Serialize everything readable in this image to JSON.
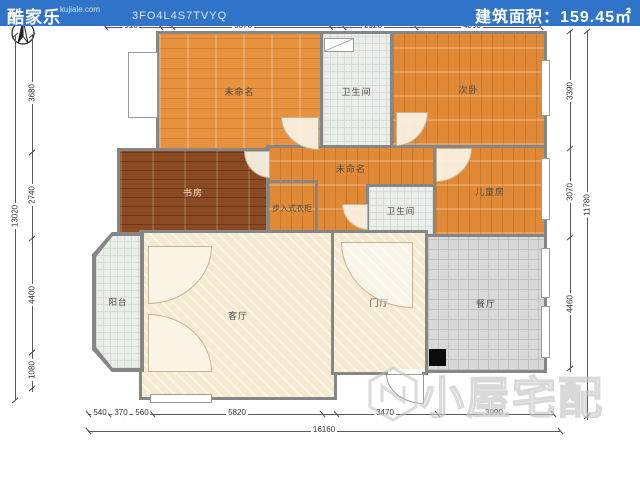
{
  "north": "北",
  "rooms": {
    "unnamed_top": "未命名",
    "bath_top": "卫生间",
    "bedroom2": "次卧",
    "study": "书房",
    "unnamed_mid": "未命名",
    "closet": "步入式衣柜",
    "bath_mid": "卫生间",
    "kids": "儿童房",
    "balcony": "阳台",
    "living": "客厅",
    "foyer": "门厅",
    "dining": "餐厅"
  },
  "dims": {
    "top_total": "14760",
    "top": [
      "910",
      "5670",
      "2920",
      "4090"
    ],
    "left_total": "13020",
    "left": [
      "3680",
      "2740",
      "4400",
      "1080"
    ],
    "right_total": "11780",
    "right": [
      "3390",
      "3070",
      "4460"
    ],
    "bottom_total": "16160",
    "bottom": [
      "540",
      "370",
      "560",
      "5820",
      "3470",
      "3990"
    ]
  },
  "watermark": "小屋宅配",
  "footer": {
    "brand": "酷家乐",
    "site": "kujiale.com",
    "code": "3FO4L4S7TVYQ",
    "area_label": "建筑面积：",
    "area_value": "159.45㎡"
  },
  "colors": {
    "footer_bg": "#2f74c8",
    "wall": "#868686",
    "wood": "#e6923e",
    "dark_wood": "#8b4a22"
  }
}
